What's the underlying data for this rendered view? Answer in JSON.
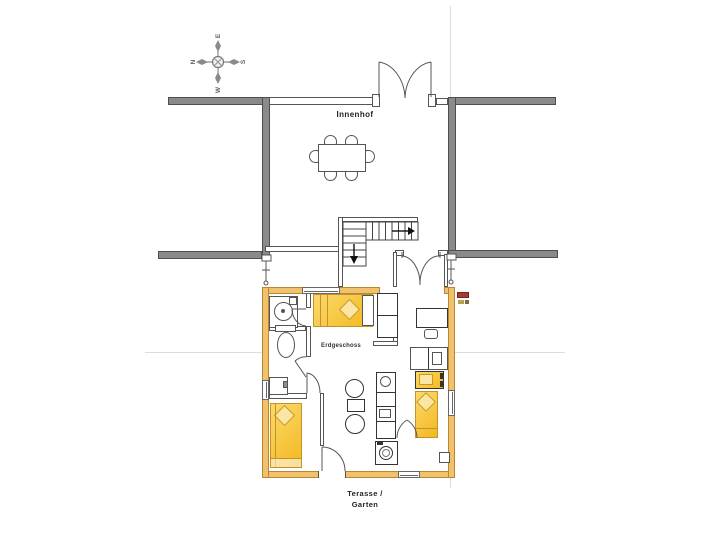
{
  "plan": {
    "title": "Erdgeschoss Grundriss",
    "labels": {
      "courtyard": "Innenhof",
      "floor": "Erdgeschoss",
      "terrace_line1": "Terasse /",
      "terrace_line2": "Garten"
    },
    "compass": {
      "north": "N",
      "east": "E",
      "south": "S",
      "west": "W"
    },
    "colors": {
      "background": "#ffffff",
      "neighbor_wall_gray": "#8a8a8a",
      "neighbor_wall_border": "#4f4f4f",
      "unit_wall_orange": "#f1c26d",
      "unit_wall_orange_border": "#b9882e",
      "furniture_yellow": "#f7c644",
      "furniture_line": "#c3922a",
      "drawing_line": "#444444",
      "reference_line": "#d9d9d9",
      "marker_red": "#a93c32"
    }
  }
}
